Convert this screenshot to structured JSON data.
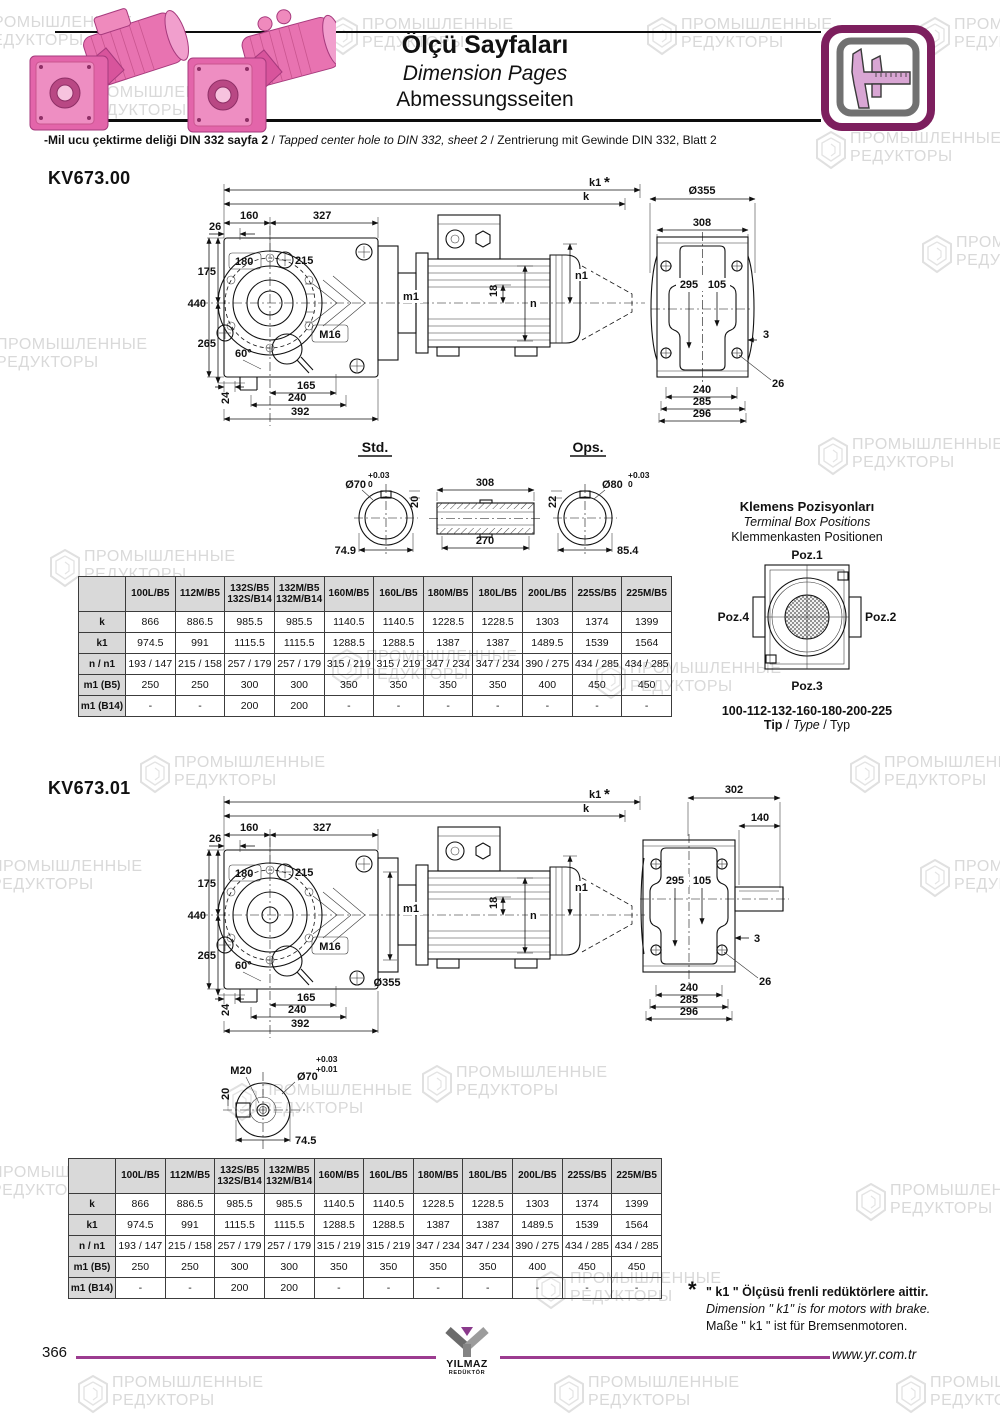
{
  "palette": {
    "accent": "#9c3c90",
    "gear_pink": "#e365aa",
    "caliper_border": "#7d1f5e",
    "watermark": "#d9d9d9"
  },
  "watermark": {
    "text": "ПРОМЫШЛЕННЫЕ\nРЕДУКТОРЫ"
  },
  "header": {
    "title_tr": "Ölçü Sayfaları",
    "title_en": "Dimension Pages",
    "title_de": "Abmessungsseiten",
    "note_tr": "-Mil ucu çektirme deliği DIN 332 sayfa 2",
    "note_sep": "/",
    "note_en": "Tapped center hole to DIN 332, sheet 2",
    "note_de": "Zentrierung mit Gewinde DIN 332, Blatt 2"
  },
  "kv67300": {
    "model": "KV673.00",
    "front": {
      "k1": "k1",
      "star": "*",
      "k": "k",
      "d160": "160",
      "d327": "327",
      "d26": "26",
      "d180": "180",
      "d215": "215",
      "d175": "175",
      "d440": "440",
      "d265": "265",
      "d60": "60°",
      "d24": "24",
      "d165": "165",
      "d240": "240",
      "d392": "392",
      "d18": "18",
      "m1": "m1",
      "n": "n",
      "n1": "n1",
      "m16": "M16"
    },
    "side": {
      "dia": "Ø355",
      "d308": "308",
      "d295": "295",
      "d105": "105",
      "d3": "3",
      "d26": "26",
      "d240": "240",
      "d285": "285",
      "d296": "296"
    },
    "std": {
      "label": "Std.",
      "dia": "Ø70",
      "tol_up": "+0.03",
      "tol_dn": "0",
      "key": "20",
      "len": "74.9"
    },
    "sleeve": {
      "d308": "308",
      "d270": "270"
    },
    "ops": {
      "label": "Ops.",
      "dia": "Ø80",
      "tol_up": "+0.03",
      "tol_dn": "0",
      "key": "22",
      "len": "85.4"
    }
  },
  "terminal": {
    "title_tr": "Klemens Pozisyonları",
    "title_en": "Terminal Box Positions",
    "title_de": "Klemmenkasten Positionen",
    "poz1": "Poz.1",
    "poz2": "Poz.2",
    "poz3": "Poz.3",
    "poz4": "Poz.4",
    "sizes": "100-112-132-160-180-200-225",
    "tip_tr": "Tip",
    "tip_en": "Type",
    "tip_de": "Typ",
    "sep": " / "
  },
  "dim_table": {
    "columns": [
      "100L/B5",
      "112M/B5",
      "132S/B5\n132S/B14",
      "132M/B5\n132M/B14",
      "160M/B5",
      "160L/B5",
      "180M/B5",
      "180L/B5",
      "200L/B5",
      "225S/B5",
      "225M/B5"
    ],
    "rows": [
      {
        "label": "k",
        "values": [
          "866",
          "886.5",
          "985.5",
          "985.5",
          "1140.5",
          "1140.5",
          "1228.5",
          "1228.5",
          "1303",
          "1374",
          "1399"
        ]
      },
      {
        "label": "k1",
        "values": [
          "974.5",
          "991",
          "1115.5",
          "1115.5",
          "1288.5",
          "1288.5",
          "1387",
          "1387",
          "1489.5",
          "1539",
          "1564"
        ]
      },
      {
        "label": "n / n1",
        "values": [
          "193 / 147",
          "215 / 158",
          "257 / 179",
          "257 / 179",
          "315 / 219",
          "315 / 219",
          "347 / 234",
          "347 / 234",
          "390 / 275",
          "434 / 285",
          "434 / 285"
        ]
      },
      {
        "label": "m1 (B5)",
        "values": [
          "250",
          "250",
          "300",
          "300",
          "350",
          "350",
          "350",
          "350",
          "400",
          "450",
          "450"
        ]
      },
      {
        "label": "m1 (B14)",
        "values": [
          "-",
          "-",
          "200",
          "200",
          "-",
          "-",
          "-",
          "-",
          "-",
          "-",
          "-"
        ]
      }
    ]
  },
  "kv67301": {
    "model": "KV673.01",
    "front": {
      "k1": "k1",
      "star": "*",
      "k": "k",
      "d160": "160",
      "d327": "327",
      "d26": "26",
      "d180": "180",
      "d215": "215",
      "d175": "175",
      "d440": "440",
      "d265": "265",
      "d60": "60°",
      "d24": "24",
      "d165": "165",
      "d240": "240",
      "d392": "392",
      "d18": "18",
      "m1": "m1",
      "n": "n",
      "n1": "n1",
      "m16": "M16",
      "dia": "Ø355"
    },
    "side": {
      "d302": "302",
      "d140": "140",
      "d295": "295",
      "d105": "105",
      "d3": "3",
      "d26": "26",
      "d240": "240",
      "d285": "285",
      "d296": "296"
    },
    "shaft": {
      "m20": "M20",
      "key": "20",
      "dia": "Ø70",
      "tol_up": "+0.03",
      "tol_dn": "+0.01",
      "len": "74.5"
    }
  },
  "footnote": {
    "star": "*",
    "line_tr": "\" k1 \" Ölçüsü frenli redüktörlere aittir.",
    "line_en": "Dimension \" k1\" is for motors with brake.",
    "line_de": "Maße \" k1 \" ist für Bremsenmotoren."
  },
  "footer": {
    "page": "366",
    "url": "www.yr.com.tr",
    "logo_line1": "YILMAZ",
    "logo_line2": "REDÜKTÖR"
  }
}
